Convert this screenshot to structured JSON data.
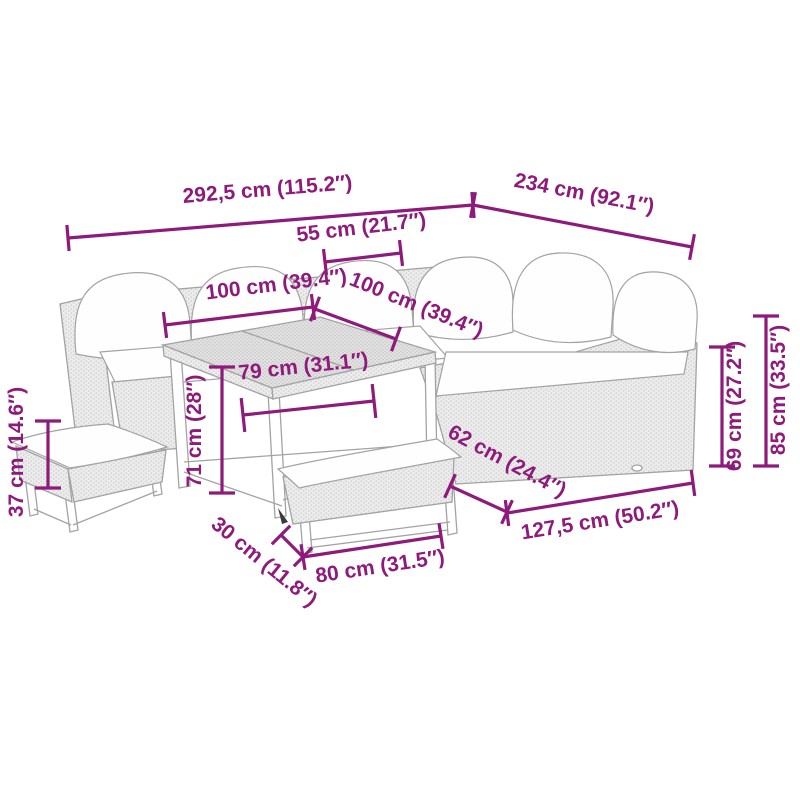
{
  "diagram": {
    "colors": {
      "accent": "#8E1A7B",
      "outline": "#A3A3A3",
      "rattanFill": "#ECECEC",
      "rattanDot": "#CFCFCF",
      "tableFill": "#E3E3E3",
      "tableDot": "#C2C2C2",
      "cushion": "#FEFEFE",
      "bg": "#FFFFFF"
    },
    "pieces": [
      "corner-sofa-left-section",
      "corner-sofa-right-section",
      "dining-table",
      "stool",
      "bench"
    ],
    "dimensions": [
      {
        "id": "total-width",
        "label": "292,5 cm (115.2″)",
        "cm": "292,5",
        "inches": "115.2"
      },
      {
        "id": "total-depth",
        "label": "234 cm (92.1″)",
        "cm": "234",
        "inches": "92.1"
      },
      {
        "id": "corner-back-width",
        "label": "55 cm (21.7″)",
        "cm": "55",
        "inches": "21.7"
      },
      {
        "id": "left-table-width",
        "label": "100 cm (39.4″)",
        "cm": "100",
        "inches": "39.4"
      },
      {
        "id": "right-table-width",
        "label": "100 cm (39.4″)",
        "cm": "100",
        "inches": "39.4"
      },
      {
        "id": "table-top-width",
        "label": "79 cm (31.1″)",
        "cm": "79",
        "inches": "31.1"
      },
      {
        "id": "table-height",
        "label": "71 cm (28″)",
        "cm": "71",
        "inches": "28"
      },
      {
        "id": "stool-height",
        "label": "37 cm (14.6″)",
        "cm": "37",
        "inches": "14.6"
      },
      {
        "id": "sofa-depth",
        "label": "62 cm (24.4″)",
        "cm": "62",
        "inches": "24.4"
      },
      {
        "id": "right-front-length",
        "label": "127,5 cm (50.2″)",
        "cm": "127,5",
        "inches": "50.2"
      },
      {
        "id": "seat-back-height",
        "label": "69 cm (27.2″)",
        "cm": "69",
        "inches": "27.2"
      },
      {
        "id": "total-height",
        "label": "85 cm (33.5″)",
        "cm": "85",
        "inches": "33.5"
      },
      {
        "id": "bench-depth",
        "label": "30 cm (11.8″)",
        "cm": "30",
        "inches": "11.8"
      },
      {
        "id": "bench-length",
        "label": "80 cm (31.5″)",
        "cm": "80",
        "inches": "31.5"
      }
    ]
  }
}
